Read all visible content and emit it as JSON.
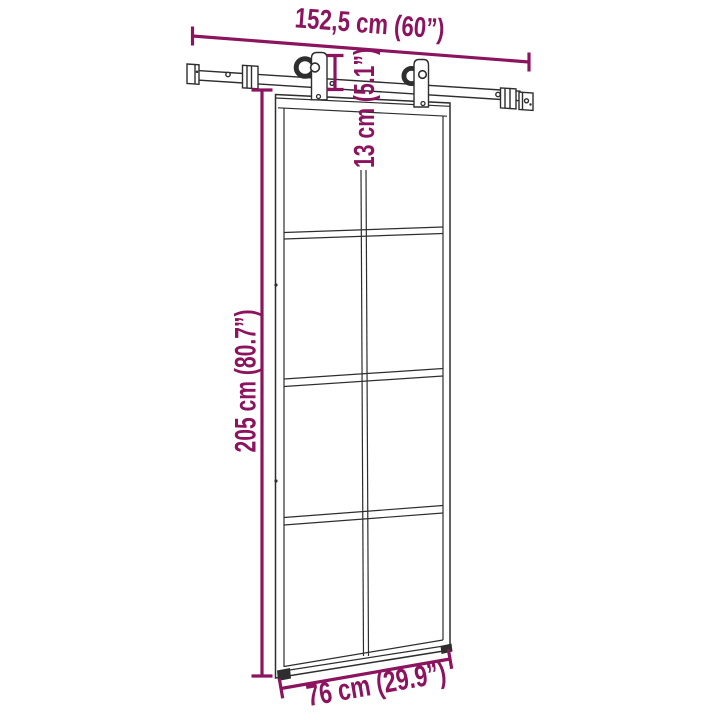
{
  "figure": {
    "title": "sliding-door-with-hardware-dimension-diagram",
    "annotations": {
      "rail_length": "152,5 cm (60”)",
      "drop": "13 cm (5.1”)",
      "height": "205 cm (80.7”)",
      "width": "76 cm (29.9”)"
    },
    "colors": {
      "dimension": "#8C145F",
      "line": "#2e2e2e",
      "background": "#ffffff"
    }
  }
}
